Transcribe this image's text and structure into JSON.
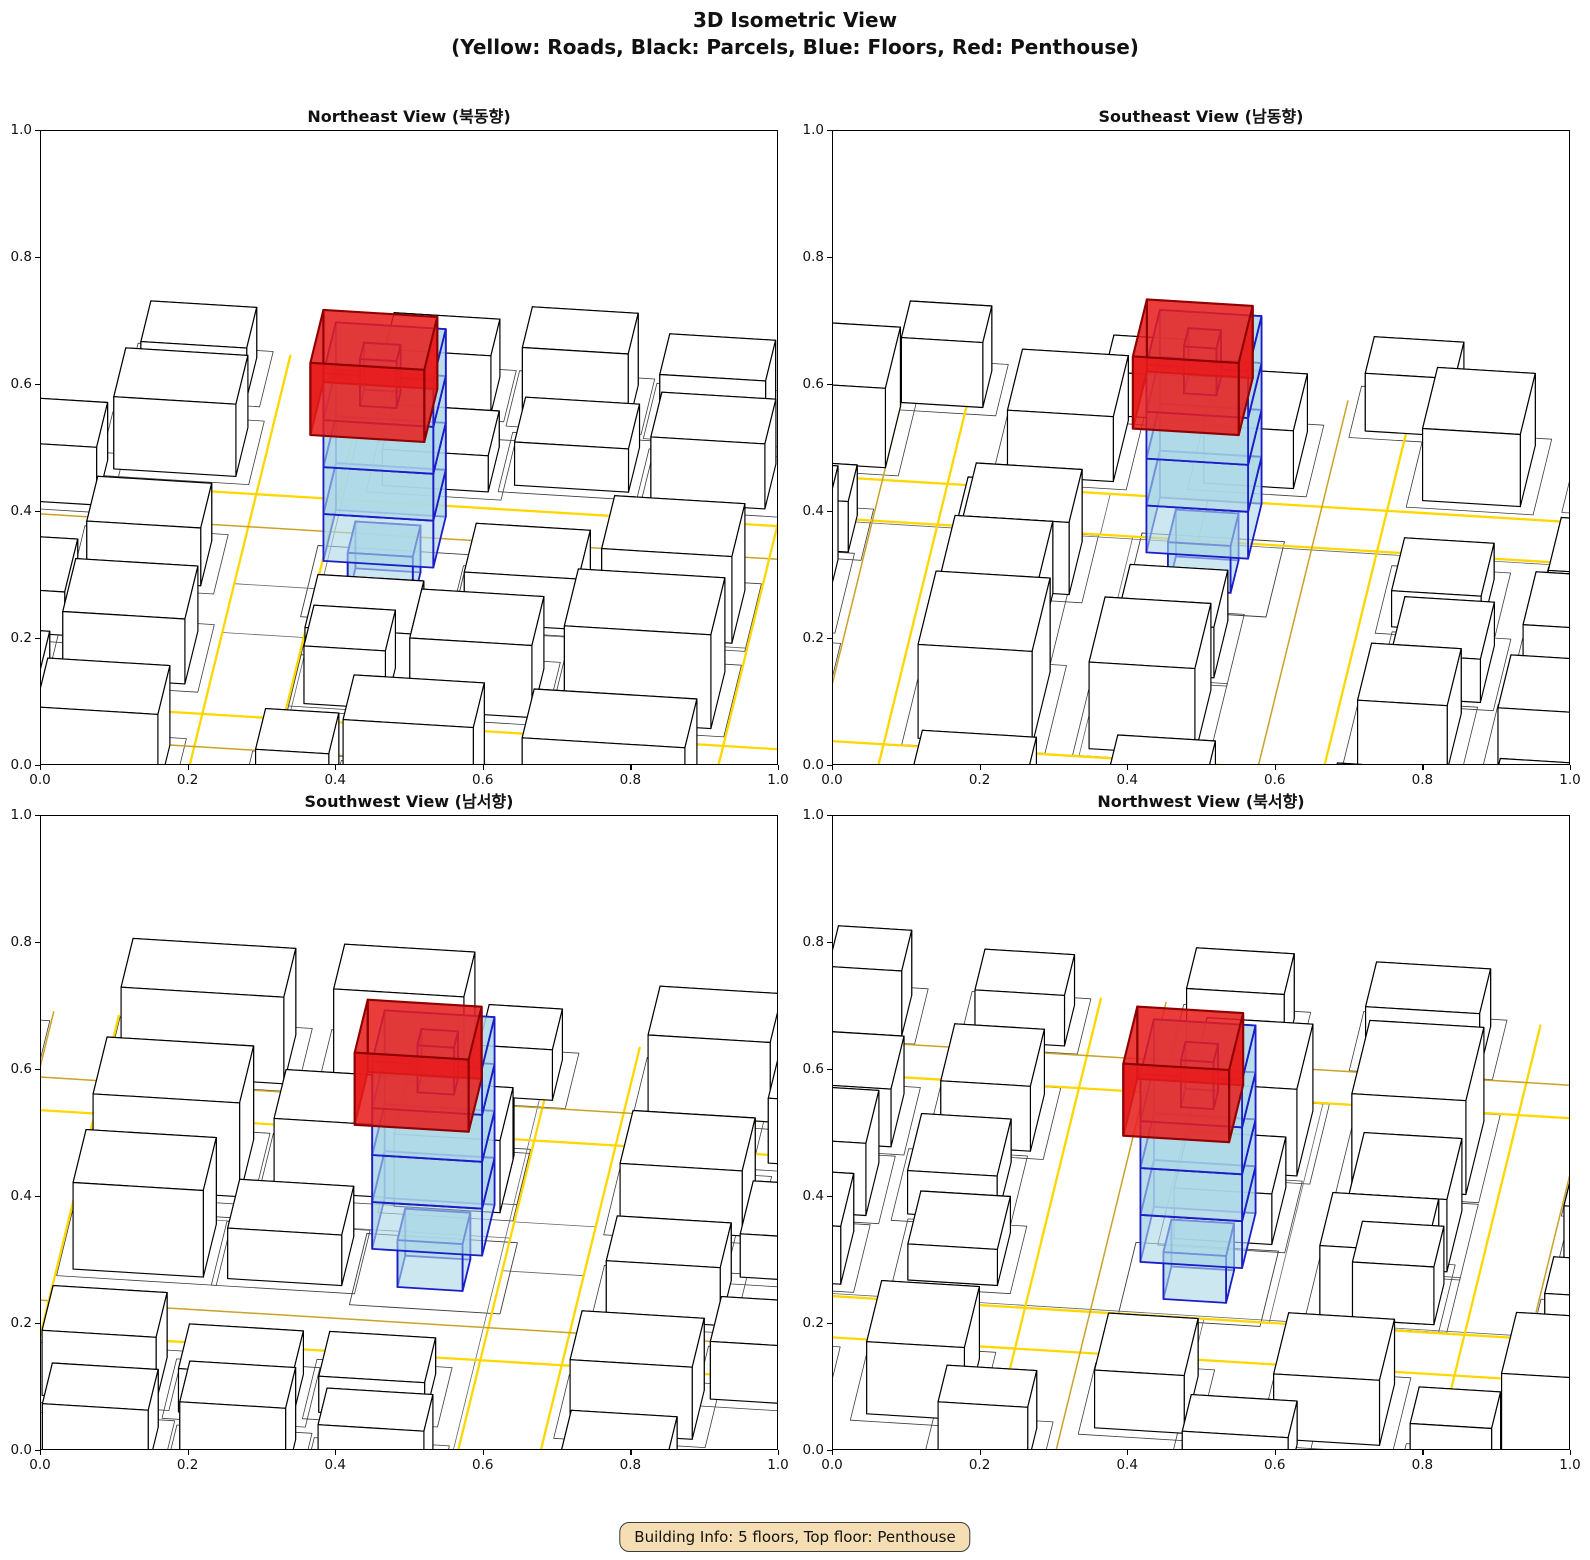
{
  "figure": {
    "title": "3D Isometric View",
    "subtitle": "(Yellow: Roads, Black: Parcels, Blue: Floors, Red: Penthouse)"
  },
  "info_box": {
    "text": "Building Info: 5 floors, Top floor: Penthouse"
  },
  "axis": {
    "tick_labels": [
      "0.0",
      "0.2",
      "0.4",
      "0.6",
      "0.8",
      "1.0"
    ],
    "tick_values": [
      0,
      0.2,
      0.4,
      0.6,
      0.8,
      1.0
    ],
    "range": [
      0,
      1
    ]
  },
  "chart_data": {
    "type": "3d-isometric-city-views",
    "title": "3D Isometric View",
    "subtitle": "(Yellow: Roads, Black: Parcels, Blue: Floors, Red: Penthouse)",
    "legend": {
      "yellow": "Roads",
      "black": "Parcels",
      "blue": "Floors",
      "red": "Penthouse"
    },
    "views": [
      {
        "id": "northeast",
        "title": "Northeast View (북동향)",
        "azimuth_deg": 97
      },
      {
        "id": "southeast",
        "title": "Southeast View (남동향)",
        "azimuth_deg": 187
      },
      {
        "id": "southwest",
        "title": "Southwest View (남서향)",
        "azimuth_deg": 277
      },
      {
        "id": "northwest",
        "title": "Northwest View (북서향)",
        "azimuth_deg": 7
      }
    ],
    "colors": {
      "road": "#FFD700",
      "road_secondary": "#C9A227",
      "parcel": "#3C3C3C",
      "building_face": "#FFFFFF",
      "building_edge": "#000000",
      "floor_face": "rgba(173,216,230,0.62)",
      "floor_edge": "#1C1CC8",
      "penthouse_face": "rgba(232,28,28,0.86)",
      "penthouse_edge": "#8F0000"
    },
    "building_info": {
      "floors": 5,
      "top_floor": "Penthouse"
    },
    "scene": {
      "roads": [
        [
          0.7,
          -0.06,
          0.7,
          1.06,
          "p"
        ],
        [
          0.8,
          -0.06,
          0.8,
          1.06,
          "p"
        ],
        [
          -0.06,
          0.28,
          1.06,
          0.28,
          "p"
        ],
        [
          -0.06,
          0.36,
          1.06,
          0.36,
          "s"
        ],
        [
          -0.06,
          0.82,
          1.06,
          0.82,
          "p"
        ],
        [
          -0.06,
          0.9,
          1.06,
          0.9,
          "s"
        ],
        [
          0.08,
          -0.06,
          0.08,
          1.06,
          "s"
        ],
        [
          0.16,
          -0.06,
          0.16,
          1.06,
          "p"
        ]
      ],
      "ground_lines": [
        [
          0.694,
          -0.06,
          0.694,
          1.06
        ],
        [
          0.7,
          0.5,
          0.8,
          0.5
        ],
        [
          0.7,
          0.62,
          0.8,
          0.62
        ],
        [
          0.16,
          0.58,
          0.7,
          0.58
        ]
      ],
      "buildings": [
        [
          0.18,
          0.64,
          0.18,
          0.14,
          0.13
        ],
        [
          0.4,
          0.66,
          0.15,
          0.12,
          0.1
        ],
        [
          0.58,
          0.68,
          0.1,
          0.1,
          0.08
        ],
        [
          0.18,
          0.44,
          0.16,
          0.13,
          0.12
        ],
        [
          0.37,
          0.44,
          0.14,
          0.12,
          0.07
        ],
        [
          0.18,
          0.92,
          0.2,
          0.12,
          0.12
        ],
        [
          0.44,
          0.93,
          0.16,
          0.11,
          0.13
        ],
        [
          0.62,
          0.92,
          0.09,
          0.1,
          0.07
        ],
        [
          0.18,
          0.13,
          0.14,
          0.11,
          0.09
        ],
        [
          0.35,
          0.11,
          0.14,
          0.11,
          0.06
        ],
        [
          0.52,
          0.13,
          0.13,
          0.11,
          0.05
        ],
        [
          0.2,
          -0.03,
          0.13,
          0.1,
          0.08
        ],
        [
          0.37,
          -0.04,
          0.13,
          0.1,
          0.1
        ],
        [
          0.54,
          -0.04,
          0.13,
          0.09,
          0.08
        ],
        [
          -0.04,
          0.9,
          0.1,
          0.12,
          0.1
        ],
        [
          -0.05,
          0.62,
          0.11,
          0.14,
          0.08
        ],
        [
          -0.04,
          0.4,
          0.1,
          0.12,
          0.09
        ],
        [
          -0.04,
          0.14,
          0.1,
          0.11,
          0.07
        ],
        [
          -0.04,
          -0.04,
          0.1,
          0.09,
          0.09
        ],
        [
          0.83,
          0.9,
          0.15,
          0.12,
          0.11
        ],
        [
          0.83,
          0.62,
          0.15,
          0.13,
          0.09
        ],
        [
          0.84,
          0.4,
          0.14,
          0.11,
          0.08
        ],
        [
          0.83,
          0.12,
          0.15,
          0.12,
          0.1
        ],
        [
          0.84,
          -0.05,
          0.13,
          0.1,
          0.07
        ],
        [
          0.99,
          0.52,
          0.09,
          0.13,
          0.06
        ],
        [
          0.99,
          0.22,
          0.09,
          0.11,
          0.08
        ],
        [
          0.99,
          0.8,
          0.09,
          0.1,
          0.09
        ],
        [
          0.55,
          0.64,
          0.13,
          0.13,
          0.1
        ]
      ],
      "subject": {
        "footprint": [
          0.55,
          0.42,
          0.685,
          0.545
        ],
        "floors": [
          [
            0.578,
            0.445,
            0.658,
            0.522,
            0.0,
            0.065
          ],
          [
            0.55,
            0.42,
            0.685,
            0.545,
            0.065,
            0.13
          ],
          [
            0.55,
            0.42,
            0.685,
            0.545,
            0.13,
            0.195
          ],
          [
            0.55,
            0.42,
            0.685,
            0.545,
            0.195,
            0.26
          ],
          [
            0.55,
            0.42,
            0.685,
            0.545,
            0.26,
            0.325
          ],
          [
            0.6,
            0.465,
            0.645,
            0.505,
            0.26,
            0.325
          ]
        ],
        "penthouse": [
          0.545,
          0.415,
          0.685,
          0.545,
          0.245,
          0.345
        ]
      }
    },
    "projection": {
      "elev_tilt": 0.5,
      "z_scale": 0.88,
      "scale": 820,
      "center": [
        0.5875,
        0.4825
      ],
      "center_y_frac": 0.72,
      "penthouse_screen_shift": [
        -13,
        4
      ]
    },
    "layout": {
      "panels": [
        {
          "x": 40,
          "y": 130,
          "w": 738,
          "h": 635
        },
        {
          "x": 832,
          "y": 130,
          "w": 738,
          "h": 635
        },
        {
          "x": 40,
          "y": 815,
          "w": 738,
          "h": 635
        },
        {
          "x": 832,
          "y": 815,
          "w": 738,
          "h": 635
        }
      ]
    }
  }
}
